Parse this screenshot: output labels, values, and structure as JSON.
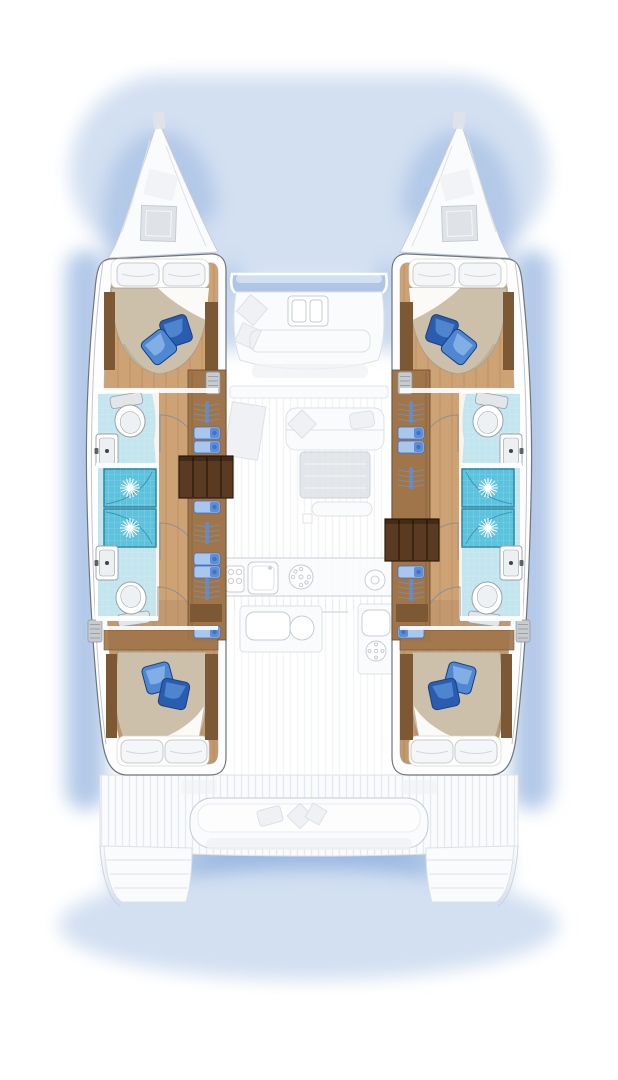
{
  "scene": {
    "kind": "catamaran yacht deck floor plan",
    "view": "overhead top-down",
    "hull_count": 2,
    "style": "interior accommodations rendered in colour; exterior decks ghosted pale grey; soft blue water shadow around hulls"
  },
  "colors": {
    "bg": "#ffffff",
    "shadow-strong": "#9ab9e2",
    "shadow": "#b3c9e8",
    "shadow-soft": "#d3e0f2",
    "ghost-line": "#c6ccd3",
    "ghost-line-soft": "#dde1e6",
    "ghost-fill": "#fafbfc",
    "ghost-fill-mid": "#eff1f4",
    "ghost-fill-dark": "#dfe3e7",
    "window-blue": "#aec6e5",
    "hull-stroke": "#6f757c",
    "hull-fill": "#fdfdfe",
    "hull-inner-line": "#c2c7cc",
    "wood-floor": "#cda275",
    "wood-floor-dark": "#b98a58",
    "plank": "#a97c4c",
    "wood-furn": "#a0754a",
    "wood-furn-dark": "#7d5835",
    "wood-trim-stroke": "#6b4a2b",
    "stairs": "#5a3a20",
    "stairs-dark": "#2f1d0e",
    "duvet": "#ccc0ab",
    "duvet-dark": "#b3a58c",
    "sheet": "#fbfaf6",
    "pillow-fill": "#f5f6f7",
    "pillow-stroke": "#c6cbd0",
    "tp-blue-light": "#5b93d8",
    "tp-blue": "#2a5cb0",
    "tp-blue-dark": "#17407f",
    "shower": "#5cc3de",
    "shower-border": "#237f9f",
    "tile": "#c2e5ef",
    "porcelain": "#ffffff",
    "porcelain-stroke": "#99a0a6",
    "porcelain-shadow": "#e2e6e9",
    "faucet": "#3f444a",
    "clothes-light": "#a9c6ec",
    "clothes": "#5d8ed6",
    "clothes-deep": "#3a6cc0",
    "hanger-gray": "#848b92",
    "vent": "#c6cbcf",
    "vent-line": "#8d939a",
    "door-arc": "#8b9197"
  },
  "port_hull": {
    "forward_cabin": {
      "bed": "island-double",
      "head_pillows": 2,
      "throw_pillows": 2,
      "sole": "teak-planked"
    },
    "forward_head": {
      "fixtures": [
        "toilet",
        "washbasin",
        "shower-stall"
      ],
      "door": "swing"
    },
    "aft_head": {
      "fixtures": [
        "shower-stall",
        "washbasin",
        "toilet"
      ],
      "door": "swing"
    },
    "shower_stalls": 2,
    "wardrobe_cells": [
      "hangers",
      "folded-garments-2",
      "companionway-stairs",
      "folded-garments-1",
      "hangers",
      "folded-garments-2",
      "hangers"
    ],
    "aft_cabin": {
      "bed": "island-double",
      "head_pillows": 2,
      "throw_pillows": 2,
      "extras": [
        "air-vent",
        "storage-tray"
      ]
    }
  },
  "starboard_hull": {
    "forward_cabin": {
      "bed": "island-double",
      "head_pillows": 2,
      "throw_pillows": 2,
      "sole": "teak-planked"
    },
    "forward_head": {
      "fixtures": [
        "toilet",
        "washbasin",
        "shower-stall"
      ],
      "door": "swing"
    },
    "aft_head": {
      "fixtures": [
        "shower-stall",
        "washbasin",
        "toilet"
      ],
      "door": "swing"
    },
    "shower_stalls": 2,
    "wardrobe_cells": [
      "hangers",
      "folded-garments-2",
      "hangers",
      "companionway-stairs",
      "folded-garments-1",
      "hangers"
    ],
    "aft_cabin": {
      "bed": "island-double",
      "head_pillows": 2,
      "throw_pillows": 2,
      "extras": [
        "air-vent",
        "storage-tray"
      ]
    }
  },
  "center_nacelle": {
    "forward_cockpit": {
      "elements": [
        "lounge-seating",
        "coffee-table",
        "scatter-cushions-2"
      ],
      "windshield_band": true
    },
    "saloon": {
      "elements": [
        "angled-seat",
        "sofa",
        "scatter-cushions",
        "dining-table",
        "bench",
        "white-pouf"
      ]
    },
    "galley": {
      "elements": [
        "cooktop-grid",
        "galley-sink",
        "burner-plate",
        "burner-plate",
        "prep-counter",
        "round-basin",
        "cold-unit"
      ]
    },
    "aft_cockpit": {
      "elements": [
        "curved-bench",
        "scatter-cushions-3",
        "teak-planked-deck",
        "transom-steps-port",
        "transom-steps-starboard"
      ]
    }
  },
  "foredeck": {
    "elements": [
      "bow-port",
      "bow-starboard",
      "deck-hatch-port",
      "deck-hatch-starboard",
      "skylight-port",
      "skylight-starboard",
      "bow-fitting-port",
      "bow-fitting-starboard"
    ]
  },
  "icons": [
    "toilet-icon",
    "washbasin-icon",
    "shower-drain-star-icon",
    "hanger-rack-icon",
    "folded-clothes-icon",
    "stairs-icon",
    "air-vent-icon",
    "deck-hatch-icon",
    "burner-icon",
    "galley-sink-icon",
    "bed-pillow-icon",
    "throw-pillow-icon",
    "door-swing-icon"
  ]
}
